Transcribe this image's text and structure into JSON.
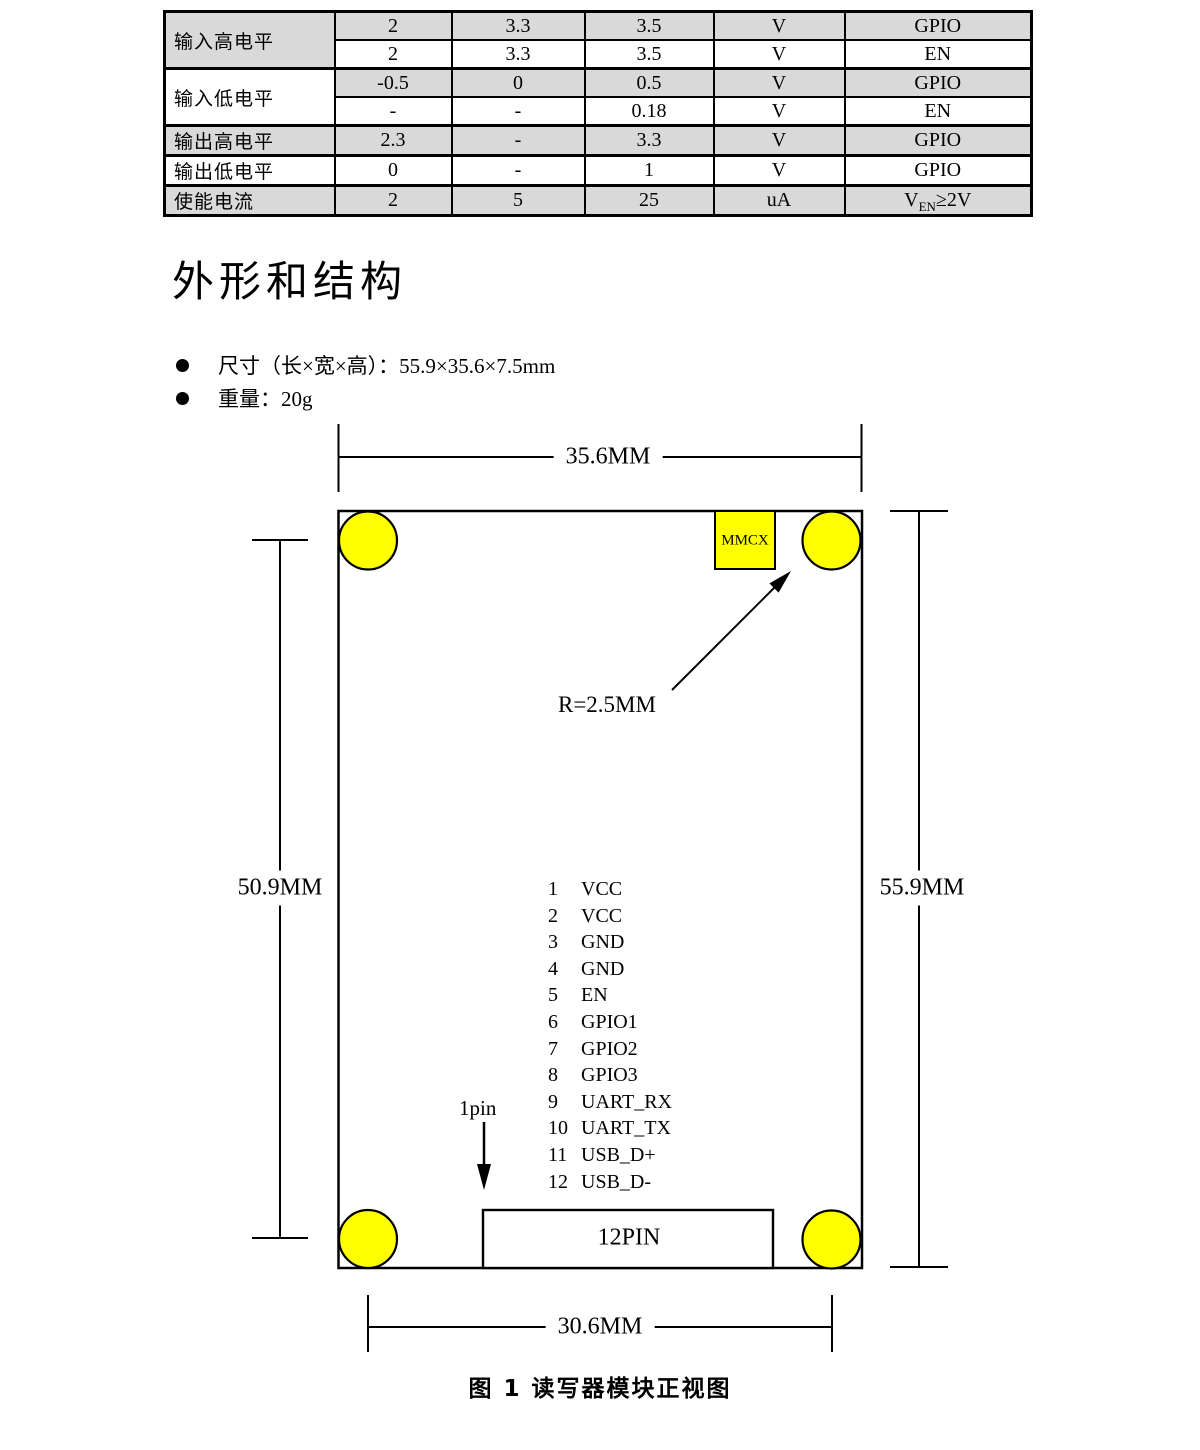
{
  "spec_table": {
    "row_groups": [
      {
        "label": "输入高电平",
        "rows": [
          [
            "2",
            "3.3",
            "3.5",
            "V",
            "GPIO"
          ],
          [
            "2",
            "3.3",
            "3.5",
            "V",
            "EN"
          ]
        ]
      },
      {
        "label": "输入低电平",
        "rows": [
          [
            "-0.5",
            "0",
            "0.5",
            "V",
            "GPIO"
          ],
          [
            "-",
            "-",
            "0.18",
            "V",
            "EN"
          ]
        ]
      },
      {
        "label": "输出高电平",
        "rows": [
          [
            "2.3",
            "-",
            "3.3",
            "V",
            "GPIO"
          ]
        ]
      },
      {
        "label": "输出低电平",
        "rows": [
          [
            "0",
            "-",
            "1",
            "V",
            "GPIO"
          ]
        ]
      },
      {
        "label": "使能电流",
        "rows": [
          [
            "2",
            "5",
            "25",
            "uA"
          ]
        ],
        "condition": {
          "pre": "V",
          "sub": "EN",
          "post": "≥2V"
        }
      }
    ],
    "shade_color": "#d9d9d9"
  },
  "section": {
    "heading": "外形和结构"
  },
  "bullets": [
    {
      "text": "尺寸（长×宽×高）：55.9×35.6×7.5mm"
    },
    {
      "text": "重量：20g"
    }
  ],
  "diagram": {
    "dim_top": "35.6MM",
    "dim_left": "50.9MM",
    "dim_right": "55.9MM",
    "dim_bottom": "30.6MM",
    "radius_label": "R=2.5MM",
    "mmcx_label": "MMCX",
    "pin1_label": "1pin",
    "connector_label": "12PIN",
    "pins": [
      {
        "num": "1",
        "label": "VCC"
      },
      {
        "num": "2",
        "label": "VCC"
      },
      {
        "num": "3",
        "label": "GND"
      },
      {
        "num": "4",
        "label": "GND"
      },
      {
        "num": "5",
        "label": "EN"
      },
      {
        "num": "6",
        "label": "GPIO1"
      },
      {
        "num": "7",
        "label": "GPIO2"
      },
      {
        "num": "8",
        "label": "GPIO3"
      },
      {
        "num": "9",
        "label": "UART_RX"
      },
      {
        "num": "10",
        "label": "UART_TX"
      },
      {
        "num": "11",
        "label": "USB_D+"
      },
      {
        "num": "12",
        "label": "USB_D-"
      }
    ],
    "colors": {
      "hole_fill": "#FFFF00",
      "line": "#000000",
      "board_fill": "#FFFFFF"
    }
  },
  "caption": "图 1 读写器模块正视图"
}
